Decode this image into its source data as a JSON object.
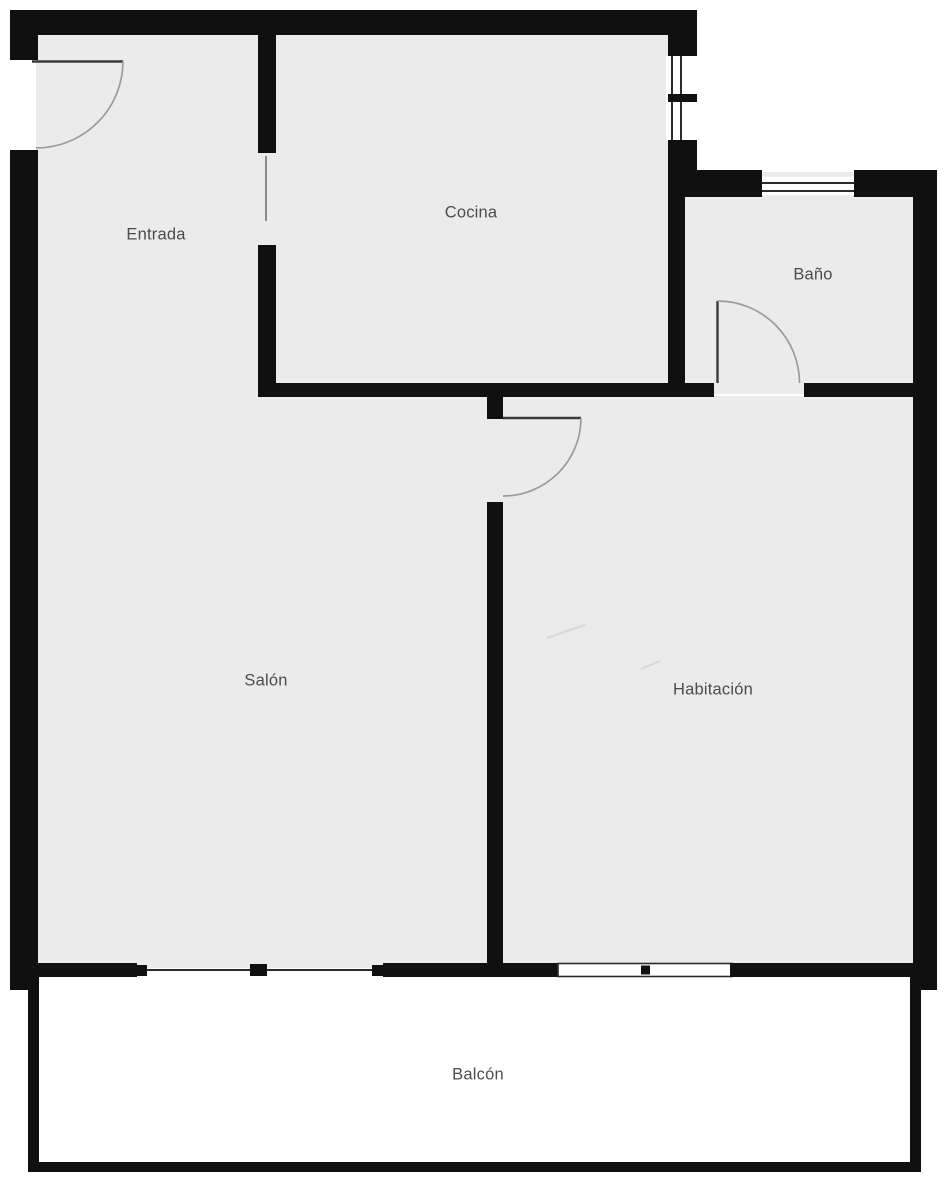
{
  "plan": {
    "type": "apartment-floor-plan",
    "rooms": [
      {
        "id": "entrada",
        "label": "Entrada"
      },
      {
        "id": "cocina",
        "label": "Cocina"
      },
      {
        "id": "bano",
        "label": "Baño"
      },
      {
        "id": "salon",
        "label": "Salón"
      },
      {
        "id": "habitacion",
        "label": "Habitación"
      },
      {
        "id": "balcon",
        "label": "Balcón"
      }
    ],
    "features": {
      "doors": [
        "entrada-swing-door",
        "salon-habitacion-swing-door",
        "bano-swing-door"
      ],
      "windows": [
        "cocina-side-window",
        "bano-top-window",
        "salon-balcony-sliding-window",
        "habitacion-balcony-window"
      ],
      "openings": [
        "entrada-cocina-opening"
      ]
    }
  },
  "colors": {
    "wall": "#101010",
    "room_fill": "#ebebeb",
    "balcony_fill": "#ffffff",
    "label_text": "#4c4c4c",
    "door_arc": "#9b9b9b",
    "window_line": "#2b2b2b",
    "background": "#ffffff"
  }
}
